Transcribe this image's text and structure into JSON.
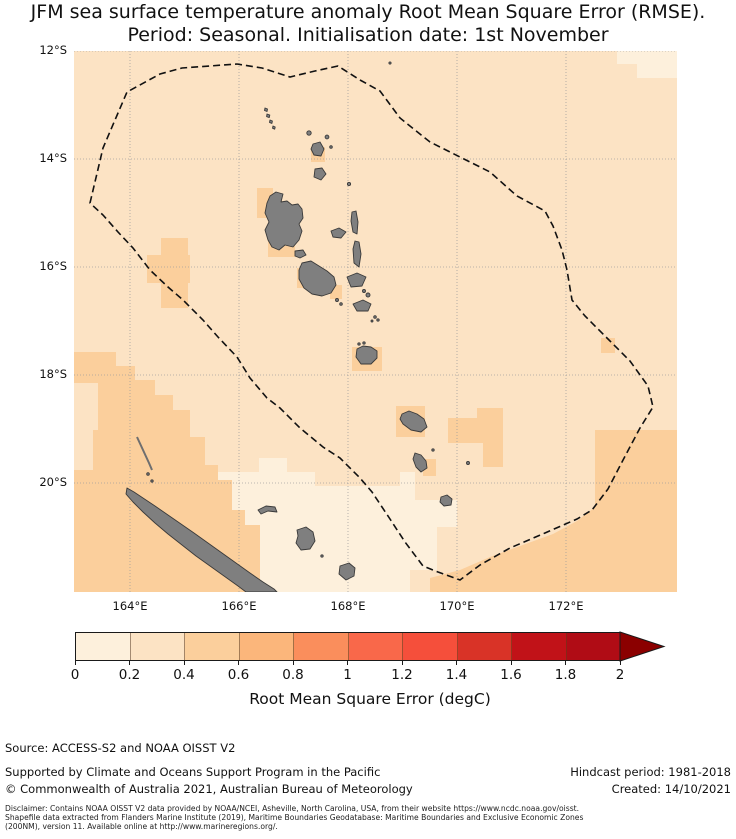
{
  "title": {
    "line1": "JFM sea surface temperature anomaly Root Mean Square Error (RMSE).",
    "line2": "Period: Seasonal. Initialisation date: 1st November"
  },
  "map": {
    "lat_ticks": [
      "12°S",
      "14°S",
      "16°S",
      "18°S",
      "20°S"
    ],
    "lon_ticks": [
      "164°E",
      "166°E",
      "168°E",
      "170°E",
      "172°E"
    ],
    "land_color": "#7f7f7f",
    "land_edge_color": "#3a3a3a",
    "eez_boundary_color": "#111111",
    "gridline_color": "#9a9a9a",
    "rmse_fill_levels": {
      "level1_0_02": "#fdf0dc",
      "level2_02_04": "#fce3c4",
      "level3_04_06": "#fbcf9c"
    }
  },
  "colorbar": {
    "ticks": [
      "0",
      "0.2",
      "0.4",
      "0.6",
      "0.8",
      "1",
      "1.2",
      "1.4",
      "1.6",
      "1.8",
      "2"
    ],
    "colors": [
      "#fdf0dc",
      "#fce3c4",
      "#fbcf9c",
      "#fbb67b",
      "#fa8e5c",
      "#f9684a",
      "#f54f3b",
      "#d93327",
      "#c11218",
      "#b00c15"
    ],
    "arrow_color": "#8b0000",
    "label": "Root Mean Square Error (degC)"
  },
  "footer": {
    "source": "Source: ACCESS-S2 and NOAA OISST V2",
    "supported": "Supported by Climate and Oceans Support Program in the Pacific",
    "copyright": "© Commonwealth of Australia 2021, Australian Bureau of Meteorology",
    "hindcast": "Hindcast period: 1981-2018",
    "created": "Created: 14/10/2021",
    "disclaimer_line1": "Disclaimer: Contains NOAA OISST V2 data provided by NOAA/NCEI, Asheville, North Carolina, USA, from their website https://www.ncdc.noaa.gov/oisst.",
    "disclaimer_line2": "Shapefile data extracted from Flanders Marine Institute (2019), Maritime Boundaries Geodatabase: Maritime Boundaries and Exclusive Economic Zones",
    "disclaimer_line3": "(200NM), version 11. Available online at http://www.marineregions.org/."
  }
}
